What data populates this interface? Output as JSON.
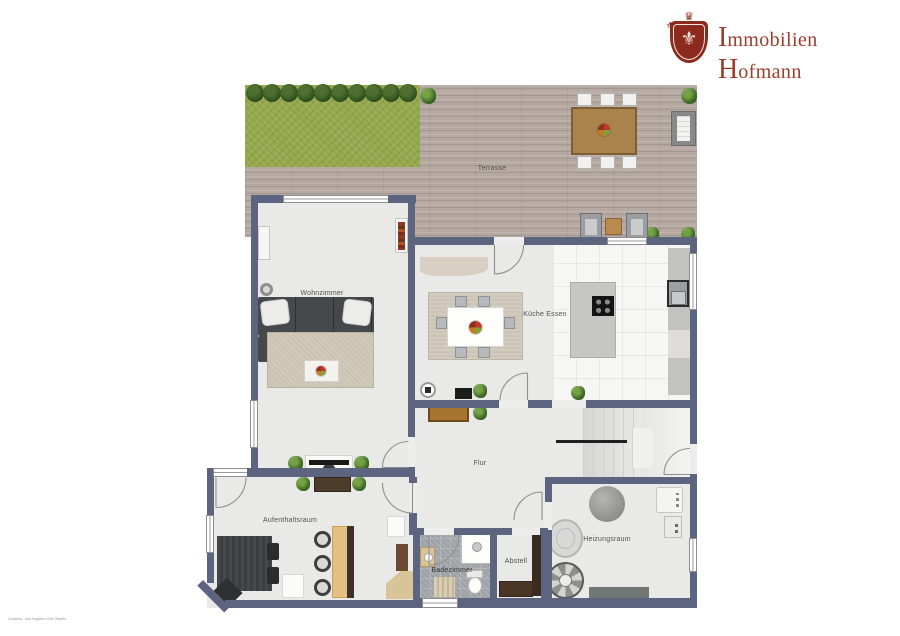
{
  "brand": {
    "word1_initial": "I",
    "word1_rest": "mmobilien",
    "word2_initial": "H",
    "word2_rest": "ofmann",
    "crest_icon": "heraldic-shield-fleur-de-lis",
    "crest_glyph": "⚜",
    "crown_glyph": "♛"
  },
  "floorplan": {
    "labels": {
      "terrasse": "Terrasse",
      "wohnzimmer": "Wohnzimmer",
      "kueche": "Küche Essen",
      "flur": "Flur",
      "aufenthaltsraum": "Aufenthaltsraum",
      "badezimmer": "Badezimmer",
      "abstell": "Abstell",
      "heizungsraum": "Heizungsraum"
    },
    "footnote": "Grundriss - alle Angaben ohne Gewähr",
    "colors": {
      "wall": "#5c6480",
      "room_floor": "#e9e9e7",
      "deck": "#b5a9a1",
      "grass": "#95a84b",
      "kitchen_tile": "#f6f6f4",
      "bath_tile": "#a6abb0",
      "brand_red": "#9c3c2d"
    }
  }
}
